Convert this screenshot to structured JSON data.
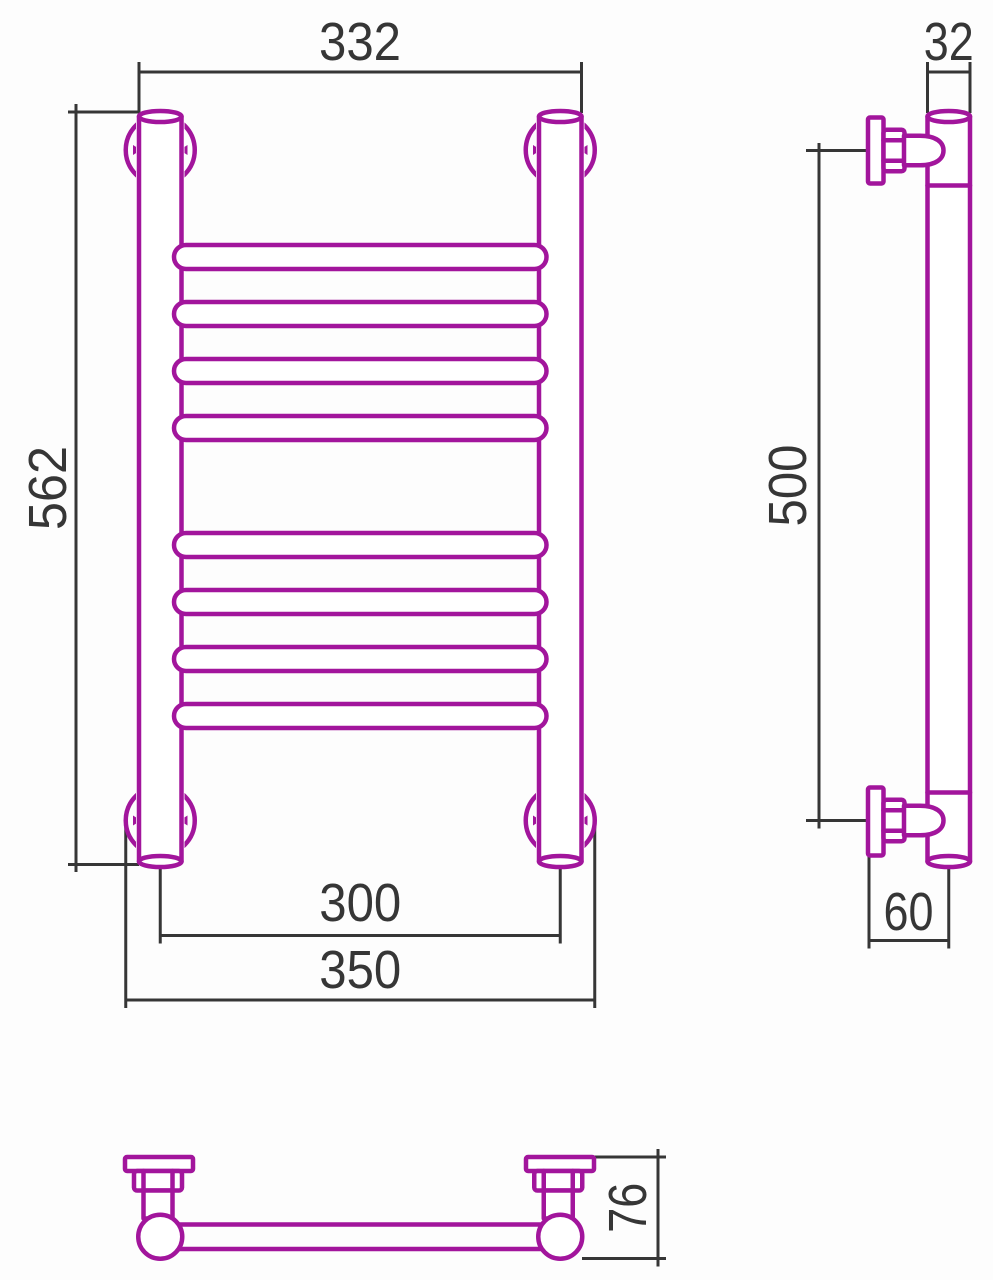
{
  "drawing": {
    "colors": {
      "outline": "#A2159C",
      "dimension_lines": "#363636",
      "background": "#FDFDFD"
    },
    "front_view": {
      "rung_count": 8,
      "rung_groups": 2,
      "dims": {
        "overall_width": "332",
        "overall_height": "562",
        "rail_axis_spacing": "300",
        "bracket_outer_width": "350"
      }
    },
    "side_view": {
      "dims": {
        "tube_diameter": "32",
        "bracket_axis_spacing": "500",
        "wall_to_tube_axis": "60"
      }
    },
    "bottom_view": {
      "dims": {
        "wall_to_front_depth": "76"
      }
    }
  }
}
